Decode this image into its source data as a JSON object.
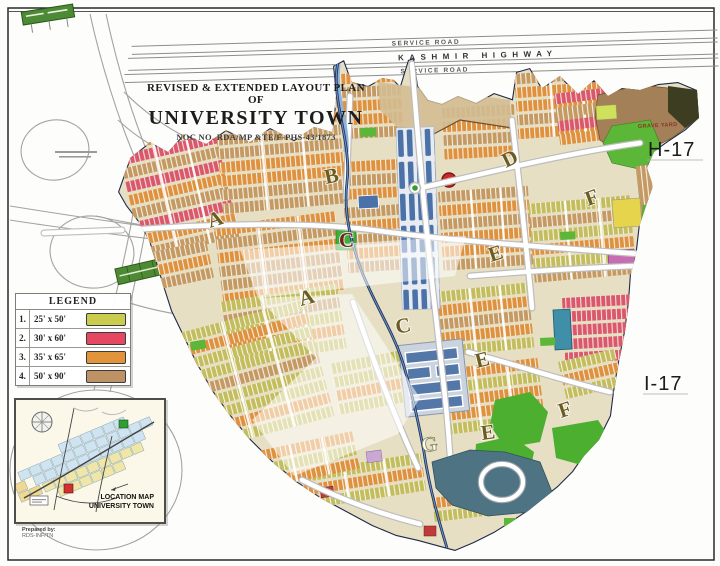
{
  "title_block": {
    "line1": "REVISED & EXTENDED LAYOUT PLAN OF",
    "line2": "UNIVERSITY TOWN",
    "line3": "NOC NO. RDA/MP &TE/F-PHS-43/1873"
  },
  "highway": {
    "service_road_top": "SERVICE ROAD",
    "name": "KASHMIR HIGHWAY",
    "service_road_bottom": "SERVICE ROAD"
  },
  "legend": {
    "title": "LEGEND",
    "rows": [
      {
        "num": "1.",
        "size": "25' x 50'",
        "color": "#c9cc4d"
      },
      {
        "num": "2.",
        "size": "30' x 60'",
        "color": "#e54860"
      },
      {
        "num": "3.",
        "size": "35' x 65'",
        "color": "#e2943b"
      },
      {
        "num": "4.",
        "size": "50' x 90'",
        "color": "#bd9264"
      }
    ]
  },
  "location_map": {
    "line1": "LOCATION MAP",
    "line2": "UNIVERSITY TOWN"
  },
  "prepared_by": {
    "line1": "Prepared by:",
    "line2": "RDS-INF/TN"
  },
  "sectors": {
    "h17": "H-17",
    "i17": "I-17"
  },
  "map": {
    "graveyard_label": "GRAVE YARD",
    "block_letters": [
      {
        "label": "A"
      },
      {
        "label": "B"
      },
      {
        "label": "C"
      },
      {
        "label": "D"
      },
      {
        "label": "E"
      },
      {
        "label": "F"
      },
      {
        "label": "A"
      },
      {
        "label": "C"
      },
      {
        "label": "E"
      },
      {
        "label": "G"
      },
      {
        "label": "E"
      },
      {
        "label": "F"
      }
    ]
  }
}
